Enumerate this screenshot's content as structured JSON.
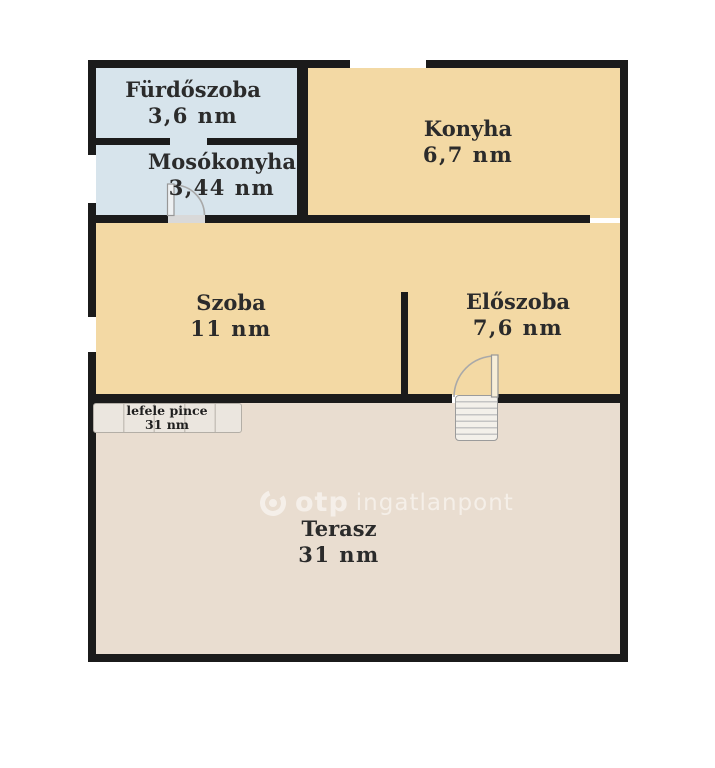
{
  "rooms": [
    {
      "name": "Fürdőszoba",
      "area": "3,6 nm"
    },
    {
      "name": "Mosókonyha",
      "area": "3,44 nm"
    },
    {
      "name": "Konyha",
      "area": "6,7 nm"
    },
    {
      "name": "Szoba",
      "area": "11 nm"
    },
    {
      "name": "Előszoba",
      "area": "7,6 nm"
    },
    {
      "name": "Terasz",
      "area": "31 nm"
    }
  ],
  "stairs": {
    "label": "lefele pince",
    "area": "31 nm"
  },
  "watermark": {
    "logo": "otp-logo-icon",
    "brand": "otp",
    "text": "ingatlanpont"
  },
  "colors": {
    "wet_room_fill": "#d7e4ec",
    "room_fill": "#f3d9a4",
    "terrace_fill": "#e9ddd0",
    "wall": "#1b1b1b",
    "label_text": "#2b2b2b",
    "watermark_white": "#ffffff"
  }
}
